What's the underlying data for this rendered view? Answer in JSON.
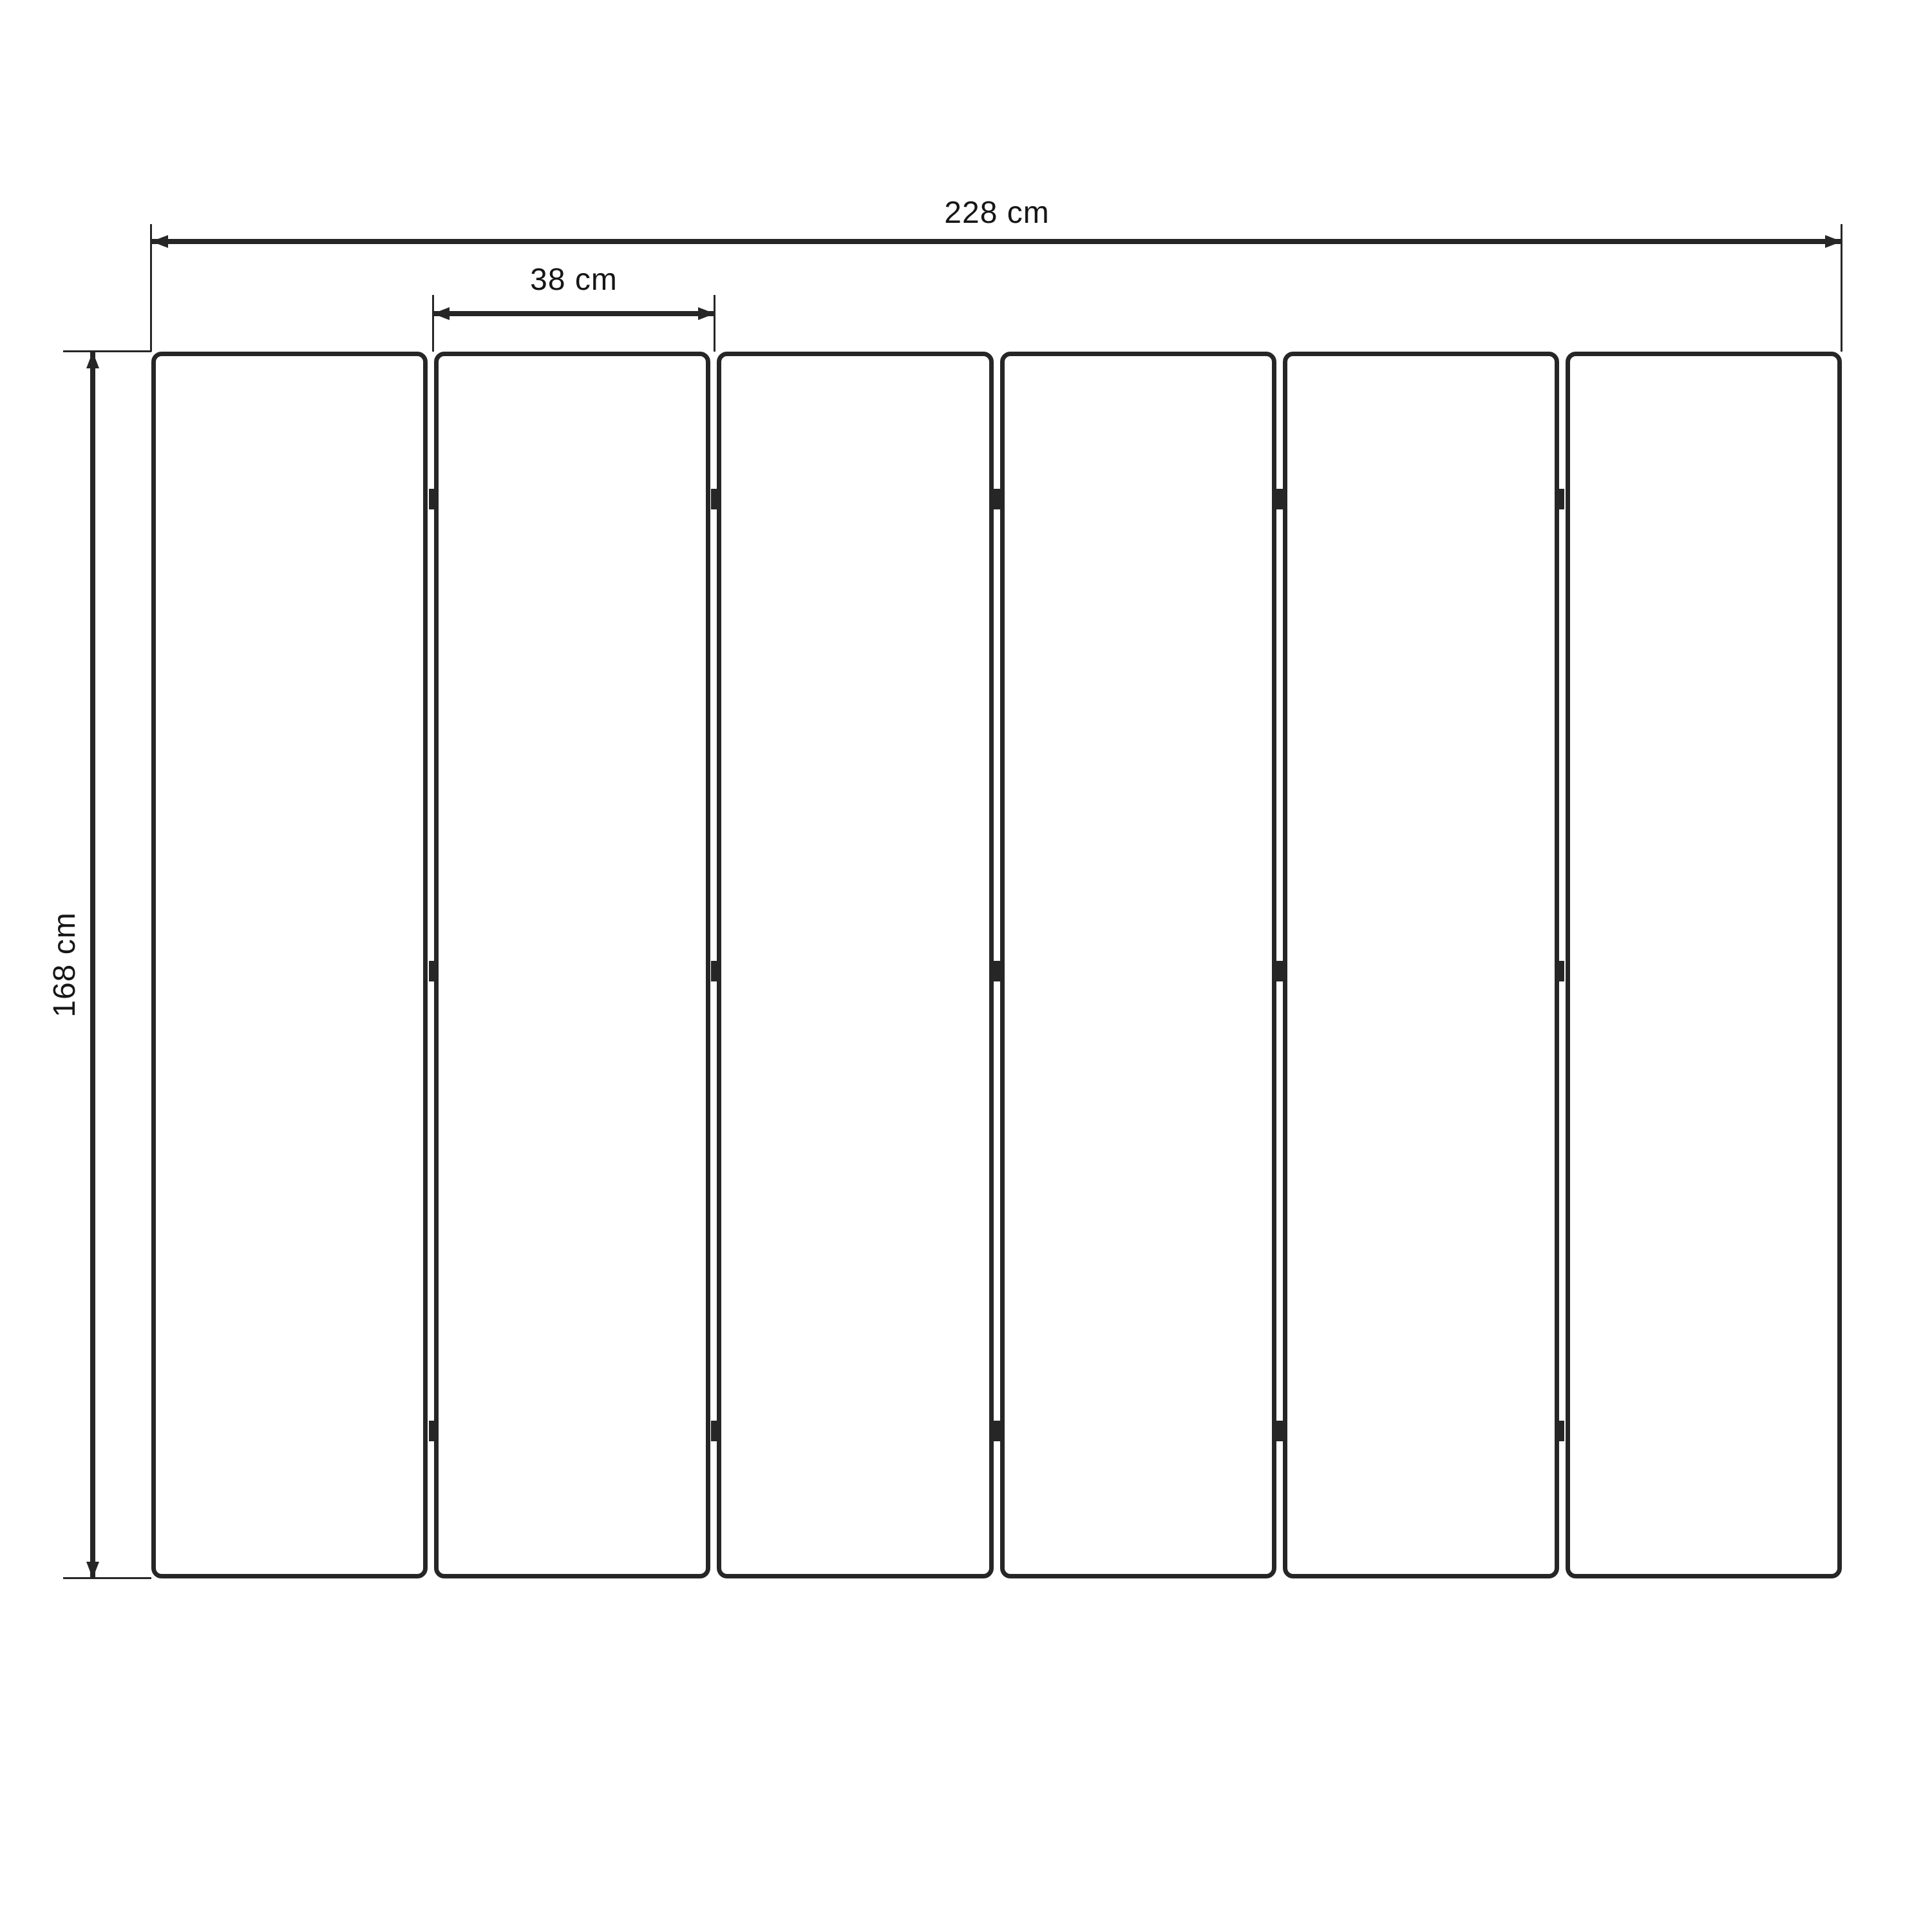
{
  "diagram": {
    "type": "technical-dimension-drawing",
    "subject": "six-panel folding screen, front elevation",
    "colors": {
      "background": "#ffffff",
      "line": "#262626",
      "text": "#161616"
    },
    "labels": {
      "total_width": "228 cm",
      "panel_width": "38 cm",
      "height": "168 cm"
    },
    "panels": {
      "count": 6,
      "gap_count": 5,
      "hinges_per_gap": 3,
      "hinge_fractions": [
        0.12,
        0.505,
        0.88
      ]
    }
  }
}
